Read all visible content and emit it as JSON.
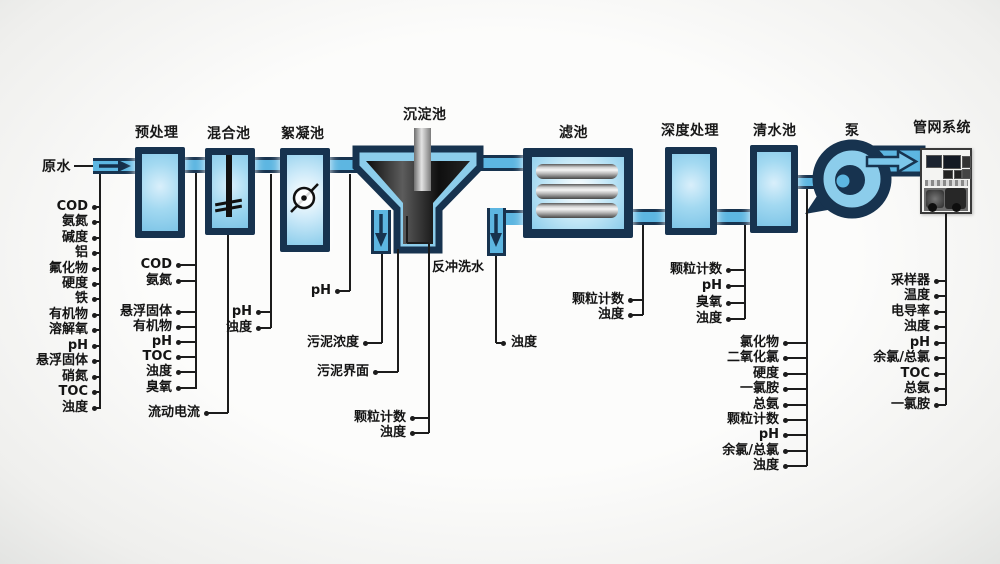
{
  "stages": [
    {
      "id": "raw-water",
      "title": "原水"
    },
    {
      "id": "pretreatment",
      "title": "预处理"
    },
    {
      "id": "mixing-tank",
      "title": "混合池"
    },
    {
      "id": "flocculation-tank",
      "title": "絮凝池"
    },
    {
      "id": "sedimentation-tank",
      "title": "沉淀池"
    },
    {
      "id": "filter-tank",
      "title": "滤池"
    },
    {
      "id": "advanced-treatment",
      "title": "深度处理"
    },
    {
      "id": "clear-water-tank",
      "title": "清水池"
    },
    {
      "id": "pump",
      "title": "泵"
    },
    {
      "id": "pipe-network",
      "title": "管网系统"
    }
  ],
  "annotations": {
    "backwash_water": "反冲洗水"
  },
  "sensor_groups": {
    "raw_water": {
      "items": [
        "COD",
        "氨氮",
        "碱度",
        "铝",
        "氟化物",
        "硬度",
        "铁",
        "有机物",
        "溶解氧",
        "pH",
        "悬浮固体",
        "硝氮",
        "TOC",
        "浊度"
      ]
    },
    "pretreatment_out": {
      "items": [
        "COD",
        "氨氮",
        "悬浮固体",
        "有机物",
        "pH",
        "TOC",
        "浊度",
        "臭氧"
      ]
    },
    "mixing_tank": {
      "items": [
        "流动电流"
      ]
    },
    "mixing_out": {
      "items": [
        "pH",
        "浊度"
      ]
    },
    "flocculation_out": {
      "items": [
        "pH"
      ]
    },
    "sludge": {
      "items": [
        "污泥浓度"
      ]
    },
    "sludge_interface": {
      "items": [
        "污泥界面"
      ]
    },
    "settled_out": {
      "items": [
        "颗粒计数",
        "浊度"
      ]
    },
    "backwash_out": {
      "items": [
        "浊度"
      ]
    },
    "filter_out": {
      "items": [
        "颗粒计数",
        "浊度"
      ]
    },
    "advanced_out": {
      "items": [
        "颗粒计数",
        "pH",
        "臭氧",
        "浊度"
      ]
    },
    "clear_water_out": {
      "items": [
        "氯化物",
        "二氧化氯",
        "硬度",
        "一氯胺",
        "总氨",
        "颗粒计数",
        "pH",
        "余氯/总氯",
        "浊度"
      ]
    },
    "network_out": {
      "items": [
        "采样器",
        "温度",
        "电导率",
        "浊度",
        "pH",
        "余氯/总氯",
        "TOC",
        "总氨",
        "一氯胺"
      ]
    }
  },
  "colors": {
    "tank_border": "#17334f",
    "tank_fill": "#8ccdeb",
    "pipe_fill": "#5db6e1",
    "line": "#1c1c1c",
    "background": "#f4f4f2"
  }
}
